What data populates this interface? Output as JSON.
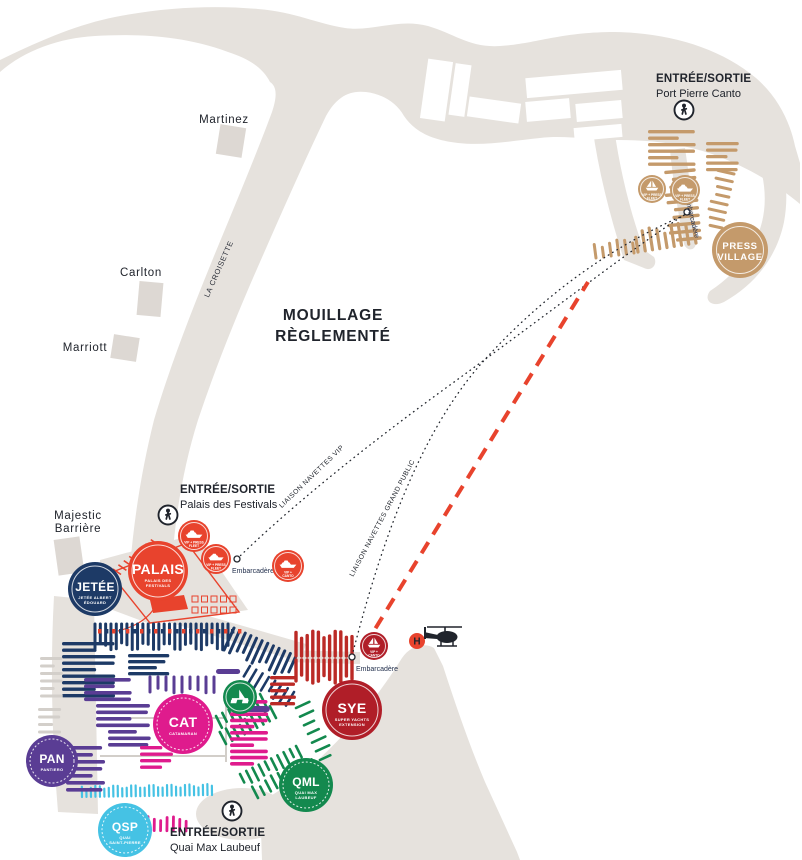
{
  "colors": {
    "land": "#e6e2dd",
    "building": "#ddd8d3",
    "accent_red": "#e8432d",
    "navy": "#1d3a66",
    "purple": "#5a3d94",
    "magenta": "#df1b8d",
    "cyan": "#45c2e4",
    "green": "#13894e",
    "crimson": "#b01e28",
    "red_boat": "#bb2a26",
    "gold": "#c49a6b",
    "grey_boat": "#d3cfca",
    "ink": "#20242c"
  },
  "entrances": {
    "canto": {
      "line1": "ENTRÉE/SORTIE",
      "line2": "Port Pierre Canto"
    },
    "palais": {
      "line1": "ENTRÉE/SORTIE",
      "line2": "Palais des Festivals"
    },
    "laubeuf": {
      "line1": "ENTRÉE/SORTIE",
      "line2": "Quai Max Laubeuf"
    }
  },
  "hotels": {
    "martinez": "Martinez",
    "carlton": "Carlton",
    "marriott": "Marriott",
    "majestic_line1": "Majestic",
    "majestic_line2": "Barrière"
  },
  "street": "LA CROISETTE",
  "notice": {
    "line1": "MOUILLAGE",
    "line2": "RÈGLEMENTÉ"
  },
  "shuttles": {
    "vip": "LIAISON NAVETTES VIP",
    "gp": "LIAISON NAVETTES GRAND PUBLIC"
  },
  "labels": {
    "embarcadere": "Embarcadère",
    "helipad": "H"
  },
  "badges": {
    "jetee": {
      "code": "JETÉE",
      "sub1": "JETÉE ALBERT",
      "sub2": "ÉDOUARD"
    },
    "palais": {
      "code": "PALAIS",
      "sub1": "PALAIS DES",
      "sub2": "FESTIVALS"
    },
    "cat": {
      "code": "CAT",
      "sub1": "CATAMARAN"
    },
    "pan": {
      "code": "PAN",
      "sub1": "PANTIERO"
    },
    "qsp": {
      "code": "QSP",
      "sub1": "QUAI",
      "sub2": "SAINT-PIERRE"
    },
    "qml": {
      "code": "QML",
      "sub1": "QUAI MAX",
      "sub2": "LAUBEUF"
    },
    "sye": {
      "code": "SYE",
      "sub1": "SUPER YACHTS",
      "sub2": "EXTENSION"
    },
    "press": {
      "line1": "PRESS",
      "line2": "VILLAGE"
    }
  },
  "fleet": {
    "cap1": "VIP + PRESS",
    "cap2": "FLEET"
  },
  "stop": {
    "cap1": "VIP +",
    "cap2": "CANTO"
  }
}
